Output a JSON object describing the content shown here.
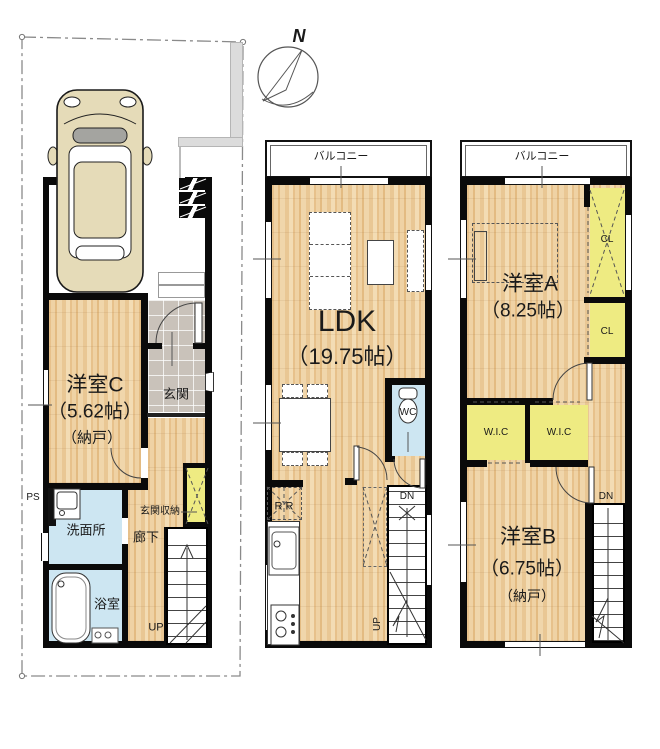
{
  "compass": {
    "north_label": "N"
  },
  "f1": {
    "room_c": {
      "name": "洋室C",
      "size": "（5.62帖）",
      "note": "（納戸）"
    },
    "entrance_label": "玄関",
    "entrance_storage_label": "玄関収納",
    "washroom_label": "洗面所",
    "bathroom_label": "浴室",
    "hallway_label": "廊下",
    "ps_label": "PS",
    "stairs_up_label": "UP"
  },
  "f2": {
    "balcony_label": "バルコニー",
    "ldk": {
      "name": "LDK",
      "size": "（19.75帖）"
    },
    "wc_label": "WC",
    "fridge_label": "R R",
    "stairs_down_label": "DN",
    "stairs_up_label": "UP"
  },
  "f3": {
    "balcony_label": "バルコニー",
    "room_a": {
      "name": "洋室A",
      "size": "（8.25帖）"
    },
    "closet1_label": "CL",
    "closet2_label": "CL",
    "wic1_label": "W.I.C",
    "wic2_label": "W.I.C",
    "room_b": {
      "name": "洋室B",
      "size": "（6.75帖）",
      "note": "（納戸）"
    },
    "stairs_down_label": "DN"
  },
  "colors": {
    "wood_floor": "#eccb9b",
    "closet_yellow": "#eeeb82",
    "wet_area_blue": "#cde6f2",
    "entrance_tile_gray": "#c9c2ba",
    "wall_black": "#0a0a0a",
    "car_body_tan": "#e5dbb8",
    "boundary_gray": "#8a8a8a"
  }
}
